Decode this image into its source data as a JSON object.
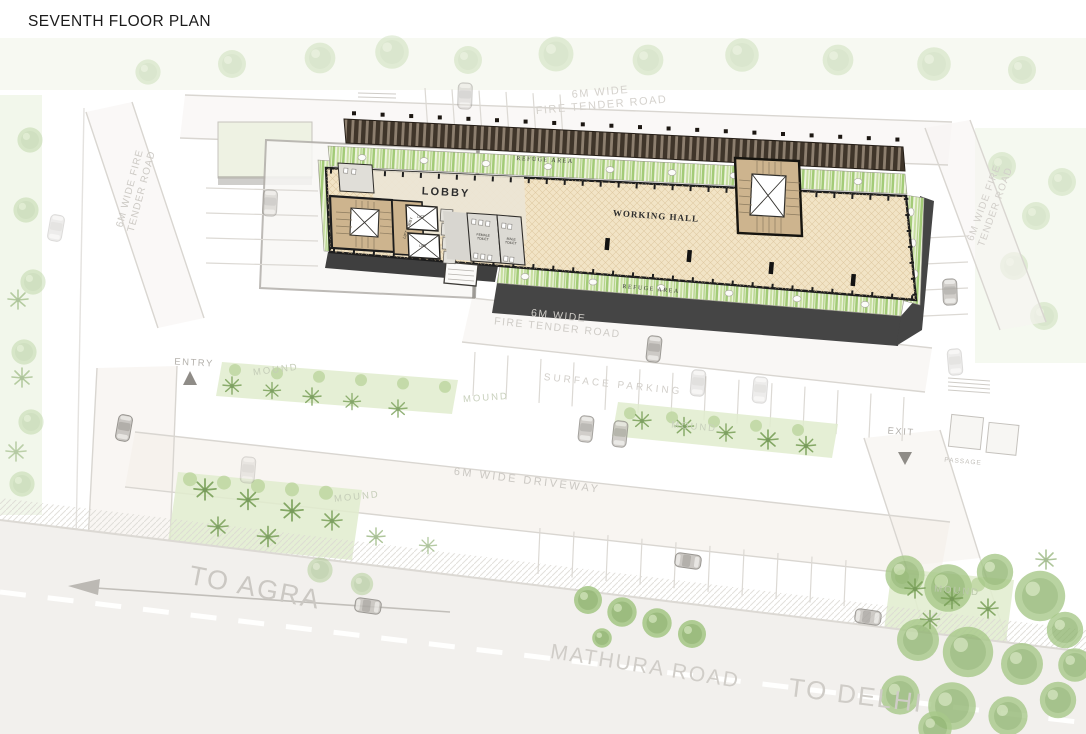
{
  "title": "SEVENTH FLOOR PLAN",
  "building": {
    "lobby": "LOBBY",
    "working_hall": "WORKING HALL",
    "refuge_area": "REFUGE AREA",
    "lift_lobby": "LIFT LOBBY",
    "lift": "LIFT",
    "female_toilet": "FEMALE TOILET",
    "male_toilet": "MALE TOILET"
  },
  "site": {
    "fire_tender_road_top": "6M WIDE\nFIRE TENDER ROAD",
    "fire_tender_road_side": "6M WIDE FIRE\nTENDER ROAD",
    "surface_parking": "SURFACE PARKING",
    "driveway": "6M WIDE DRIVEWAY",
    "mound": "MOUND",
    "entry": "ENTRY",
    "exit": "EXIT",
    "passage": "PASSAGE"
  },
  "roads": {
    "mathura_road": "MATHURA ROAD",
    "to_agra": "TO AGRA",
    "to_delhi": "TO DELHI"
  },
  "colors": {
    "floor_beige": "#f2e4c6",
    "core_tan": "#cdb48e",
    "planting_green": "#b9d48e",
    "pergola_dark": "#3f352a",
    "shadow_gray": "#454545",
    "faint_label": "#cbc8c3",
    "ink": "#1d1d1d"
  }
}
